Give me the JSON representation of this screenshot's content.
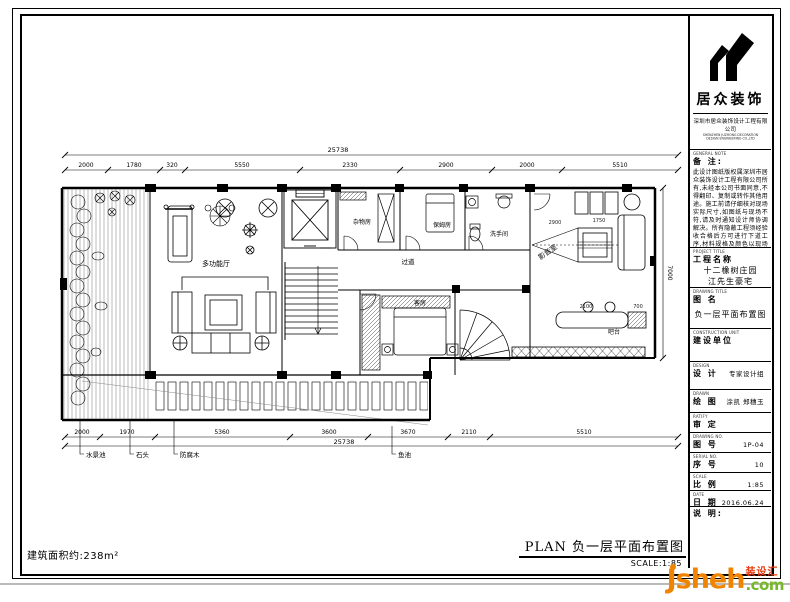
{
  "watermark": {
    "brand": "Jsheh",
    "com": ".com",
    "cn": "装设汇",
    "orange": "#F08300",
    "green": "#76B82A",
    "red": "#E8380D"
  },
  "footer": {
    "area_note": "建筑面积约:238m²",
    "plan_title": "PLAN  负一层平面布置图",
    "scale_label": "SCALE:1:85"
  },
  "titleblock": {
    "logo_text": "居众装饰",
    "company_cn": "深圳市居众装饰设计工程有限公司",
    "company_en": "SHENZHEN JUZHONG DECORATION DESIGN ENGINEERING CO.,LTD",
    "note": {
      "en": "GENERAL NOTE",
      "cn": "备 注:",
      "body": "此设计图纸版权属深圳市居众装饰设计工程有限公司所有,未经本公司书面同意,不得翻印、复制或转作其他用途。施工前请仔细核对现场实际尺寸,如图纸与现场不符,请及时通知设计师协调解决。所有隐蔽工程须经验收合格后方可进行下道工序,材料规格及颜色以现场样板为准。本图纸须经客户签字确认后方可施工,未尽事宜双方协商解决,敬请配合,谢谢!"
    },
    "project": {
      "en": "PROJECT TITLE",
      "cn": "工程名称",
      "line1": "十二橡树庄园",
      "line2": "江先生豪宅"
    },
    "drawing": {
      "en": "DRAWING TITLE",
      "cn": "图  名",
      "value": "负一层平面布置图"
    },
    "construction": {
      "en": "CONSTRUCTION UNIT",
      "cn": "建设单位",
      "value": ""
    },
    "design": {
      "en": "DESIGN",
      "cn": "设 计",
      "value": "专家设计组"
    },
    "drawn": {
      "en": "DRAWN",
      "cn": "绘 图",
      "value": "涂凯 郑穗玉"
    },
    "approve": {
      "en": "RATIFY",
      "cn": "审 定",
      "value": ""
    },
    "dwg_no": {
      "en": "DRAWING NO.",
      "cn": "图 号",
      "value": "1P-04"
    },
    "serial": {
      "en": "SERIAL NO.",
      "cn": "序 号",
      "value": "10"
    },
    "scale": {
      "en": "SCALE",
      "cn": "比 例",
      "value": "1:85"
    },
    "date": {
      "en": "DATE",
      "cn": "日 期",
      "value": "2016.06.24"
    },
    "remark": {
      "cn": "说 明:",
      "value": ""
    }
  },
  "plan": {
    "dims": {
      "overall_top": "25738",
      "top": [
        "2000",
        "1780",
        "320",
        "5550",
        "2330",
        "2900",
        "2000",
        "5510"
      ],
      "bottom": [
        "2000",
        "1970",
        "5360",
        "3600",
        "3670",
        "2110",
        "5510"
      ],
      "overall_bottom": "25738",
      "right": "7000"
    },
    "interior_dims": {
      "media_w": "2900",
      "media_s": "1750",
      "bar_w": "2100",
      "bar_s": "700"
    },
    "rooms": {
      "hall": "多功能厅",
      "storage": "杂物房",
      "nanny": "保姆房",
      "bath": "洗手间",
      "corridor": "过道",
      "guest": "客房",
      "media": "影音室",
      "bar": "吧台"
    },
    "leaders": [
      "水景池",
      "石头",
      "防腐木",
      "鱼池"
    ]
  }
}
